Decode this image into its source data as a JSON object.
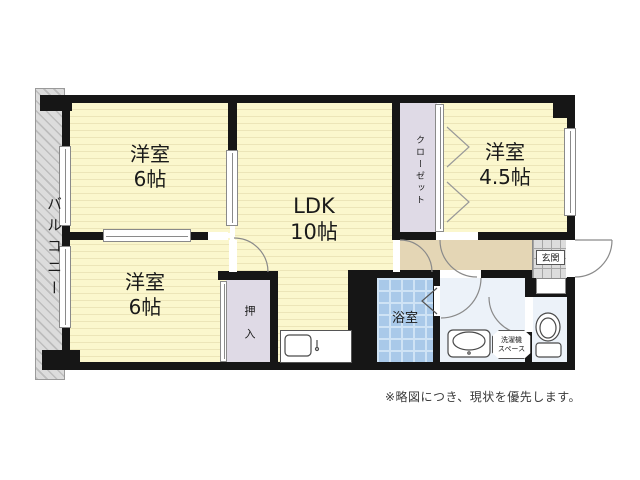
{
  "floorplan": {
    "balcony": {
      "label": "バルコニー"
    },
    "bedroom_top": {
      "name": "洋室",
      "size": "6帖"
    },
    "bedroom_bottom": {
      "name": "洋室",
      "size": "6帖"
    },
    "bedroom_right": {
      "name": "洋室",
      "size": "4.5帖"
    },
    "ldk": {
      "name": "LDK",
      "size": "10帖"
    },
    "bath": {
      "label": "浴室"
    },
    "oshiire": {
      "label": "押入"
    },
    "closet": {
      "label": "クローゼット"
    },
    "entrance": {
      "label": "玄関"
    },
    "laundry": {
      "line1": "洗濯機",
      "line2": "スペース"
    }
  },
  "note": {
    "disclaimer": "※略図につき、現状を優先します。"
  },
  "colors": {
    "wall": "#161616",
    "room_fill": "#fbf7cd",
    "room_stripe": "#ece5b8",
    "hallway": "#e4d6b5",
    "closet_fill": "#dfdae6",
    "bath_fill": "#a9c9e9",
    "sanitary_fill": "#ecf2f9",
    "balcony_fill": "#dcdcdc",
    "text": "#1a1a1a"
  }
}
